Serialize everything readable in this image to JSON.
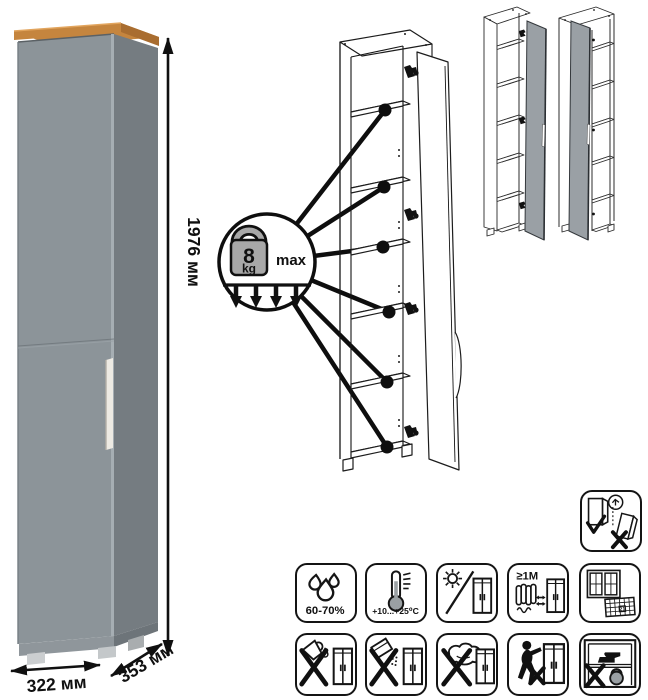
{
  "colors": {
    "door": "#8c9499",
    "side": "#757c81",
    "top-wood": "#c5853e",
    "top-wood-side": "#a96d30",
    "handle": "#edeae3",
    "feet": "#cbced0",
    "variant-door": "#9aa0a5"
  },
  "dimensions": {
    "height": "1976 мм",
    "width": "322 мм",
    "depth": "353 мм"
  },
  "shelf_load": {
    "value": "8",
    "unit": "kg",
    "qualifier": "max"
  },
  "care_labels": {
    "humidity": "60-70%",
    "temperature": "+10...+25⁰C",
    "heat_distance": "≥1М",
    "calendar_day": "21"
  },
  "icons": [
    "humidity-icon",
    "temperature-icon",
    "no-direct-sunlight-icon",
    "heat-source-distance-icon",
    "ventilation-icon",
    "no-liquids-icon",
    "no-abrasives-icon",
    "no-wet-cloth-icon",
    "no-dragging-icon",
    "no-overload-icon",
    "anti-tip-anchor-icon"
  ]
}
